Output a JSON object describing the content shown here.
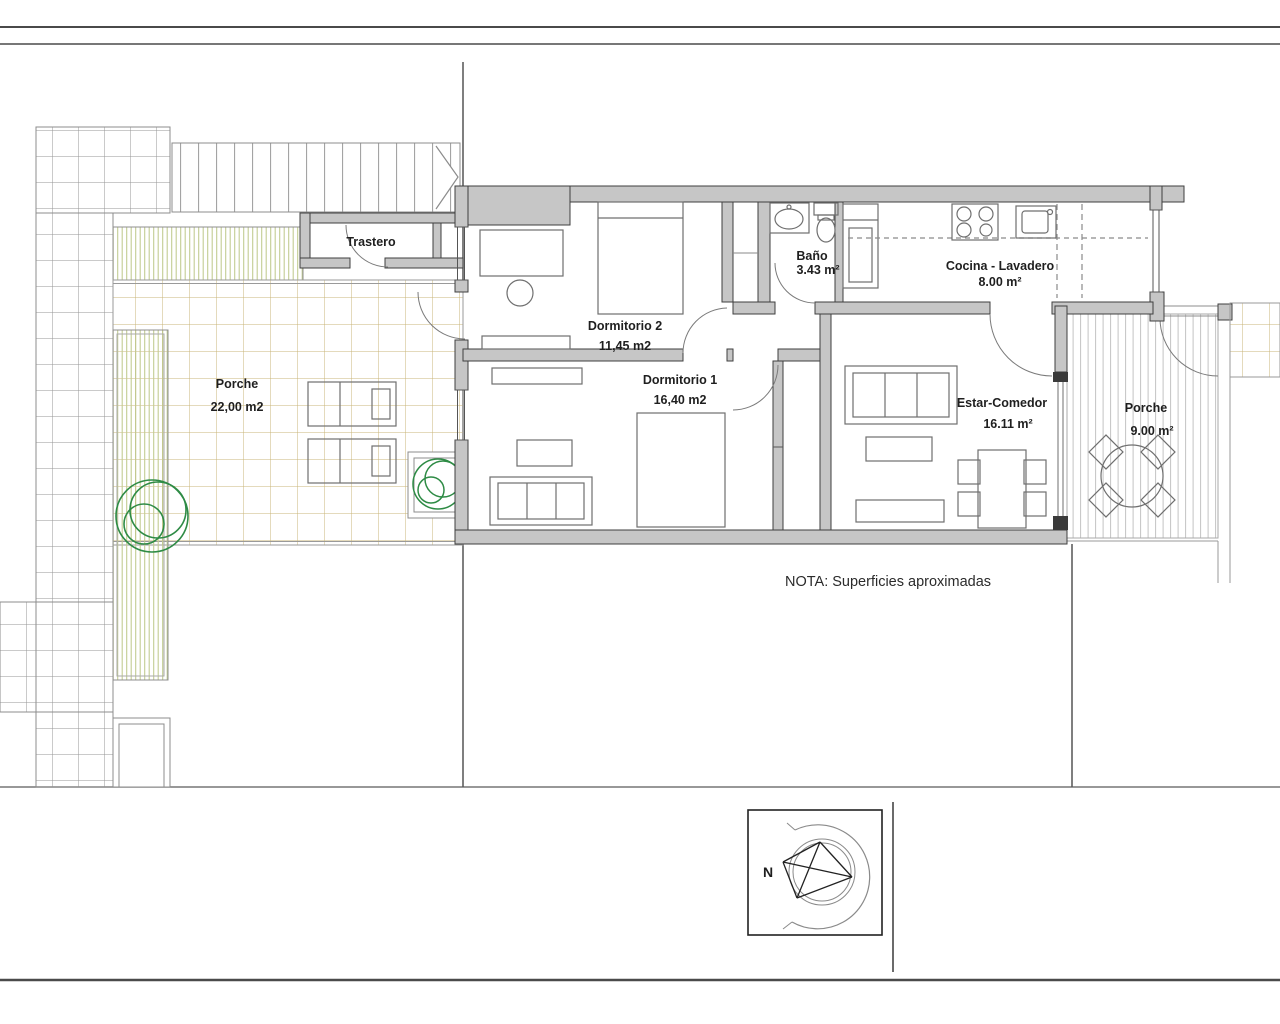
{
  "plan": {
    "rooms": [
      {
        "name": "Trastero",
        "area": ""
      },
      {
        "name": "Dormitorio 2",
        "area": "11,45 m2"
      },
      {
        "name": "Dormitorio 1",
        "area": "16,40 m2"
      },
      {
        "name": "Baño",
        "area": "3.43 m²"
      },
      {
        "name": "Cocina - Lavadero",
        "area": "8.00 m²"
      },
      {
        "name": "Estar-Comedor",
        "area": "16.11 m²"
      },
      {
        "name": "Porche",
        "area": "22,00 m2"
      },
      {
        "name": "Porche",
        "area": "9.00 m²"
      }
    ],
    "note": "NOTA: Superficies aproximadas",
    "compass": {
      "north_label": "N"
    }
  },
  "colors": {
    "wall_fill": "#c6c6c6",
    "wall_stroke": "#3f3f3f",
    "gray_grid_line": "#959595",
    "tan_tile_line": "#c9b478",
    "green_stripe": "#c2cc92",
    "deck_stripe": "#c3c3c3",
    "stair_stripe": "#9a9a9a",
    "tree_green": "#2e8b45",
    "border_line": "#4a4a4a",
    "text": "#1f1f1f"
  }
}
